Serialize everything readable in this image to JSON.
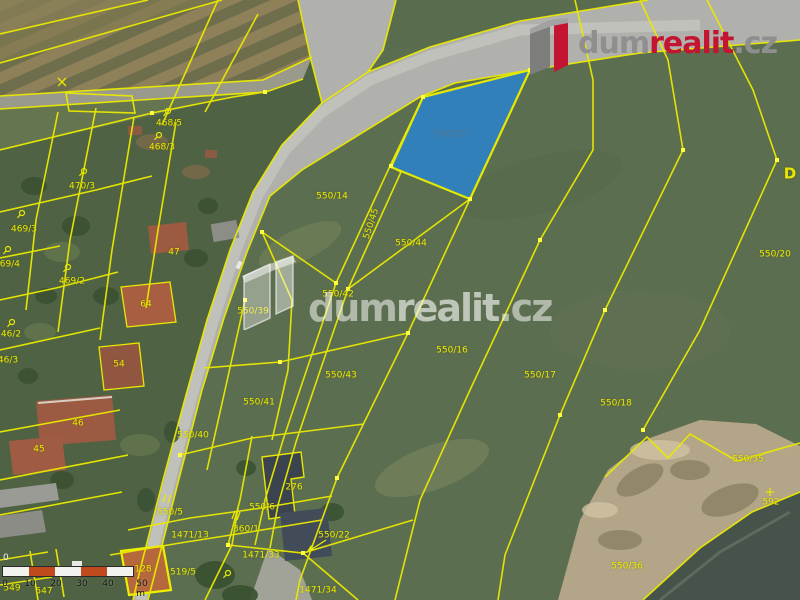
{
  "brand": {
    "logo_dum": "dum",
    "logo_realit": "realit",
    "logo_cz": ".cz",
    "watermark_dum": "dum",
    "watermark_realit": "realit",
    "watermark_cz": ".cz",
    "corner_letter": "D"
  },
  "highlight": {
    "parcel_number": "550/15",
    "fill_color": "#2e82c2",
    "outline_color": "#edf200"
  },
  "colors": {
    "boundary_yellow": "#eaea00",
    "label_yellow": "#e9e900",
    "logo_red": "#c31432",
    "logo_gray": "#8f8f8f",
    "scale_orange": "#bf4a1e"
  },
  "parcel_labels": [
    "468/5",
    "468/3",
    "470/3",
    "469/3",
    "469/4",
    "469/2",
    "46/2",
    "46/3",
    "47",
    "64",
    "54",
    "46",
    "45",
    "128",
    "276",
    "550/14",
    "550/44",
    "550/45",
    "550/42",
    "550/39",
    "550/43",
    "550/16",
    "550/17",
    "550/18",
    "550/20",
    "550/41",
    "550/40",
    "550/35",
    "550/36",
    "592",
    "550/5",
    "550/6",
    "360/1",
    "1471/13",
    "1471/33",
    "519/5",
    "549",
    "547",
    "550/22",
    "1471/34"
  ],
  "scale_bar": {
    "top_zero": "0",
    "tick_labels": [
      "0",
      "10",
      "20",
      "30",
      "40",
      "50 m"
    ]
  }
}
